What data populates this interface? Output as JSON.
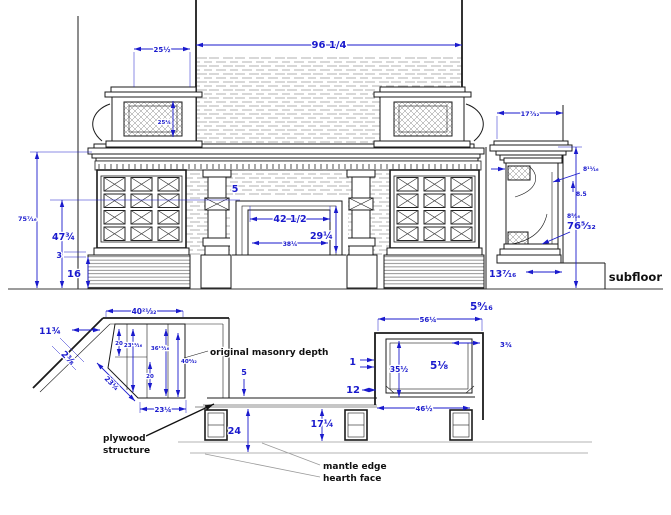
{
  "colors": {
    "dimension_blue": "#1a1acd",
    "line_black": "#1b1b1b",
    "hatch_gray": "#9a9a9a",
    "label_black": "#111111"
  },
  "front": {
    "overall_width": "96 1/4",
    "pedestal_width": "25½",
    "pedestal_height": "25¼",
    "height_to_shelf": "75⁷⁄₁₆",
    "height_to_opening": "47¾",
    "reveal": "3",
    "base_height": "16",
    "surround_leg": "5",
    "opening_width": "42 1/2",
    "opening_height": "29¼",
    "masonry_width": "38¼",
    "hearth_depth": "13⁷⁄₁₆",
    "subfloor_label": "subfloor"
  },
  "side": {
    "shelf_depth": "17⁷⁄₃₂",
    "frieze_depth": "8¹¹⁄₁₆",
    "bracket_offset": "8.5",
    "leg_depth": "8⁵⁄₁₆",
    "overall_height": "76⁵⁄₃₂"
  },
  "plan_left": {
    "cabinet_width": "40²¹⁄₃₂",
    "return_width": "11¾",
    "wall_thickness": "2⅜",
    "panel_a": "20",
    "panel_b": "23¹¹⁄₁₆",
    "panel_c": "36¹¹⁄₁₆",
    "panel_d": "40⁹⁄₃₂",
    "panel_e": "20",
    "angled_face": "23¼",
    "front_face": "23¼",
    "masonry_note": "original masonry depth",
    "masonry_thickness": "5",
    "hearth_depth": "24",
    "plywood_note_line1": "plywood",
    "plywood_note_line2": "structure"
  },
  "plan_right": {
    "wall_offset": "5⁹⁄₁₆",
    "outer_width": "56¼",
    "corner_offset": "3¾",
    "wall_thickness": "1",
    "inner_depth": "35½",
    "structure_thickness": "5¹⁄₈",
    "side_gap": "12",
    "inner_width": "46½",
    "mantle_depth": "17¼",
    "mantle_edge_note": "mantle edge",
    "hearth_face_note": "hearth face"
  }
}
